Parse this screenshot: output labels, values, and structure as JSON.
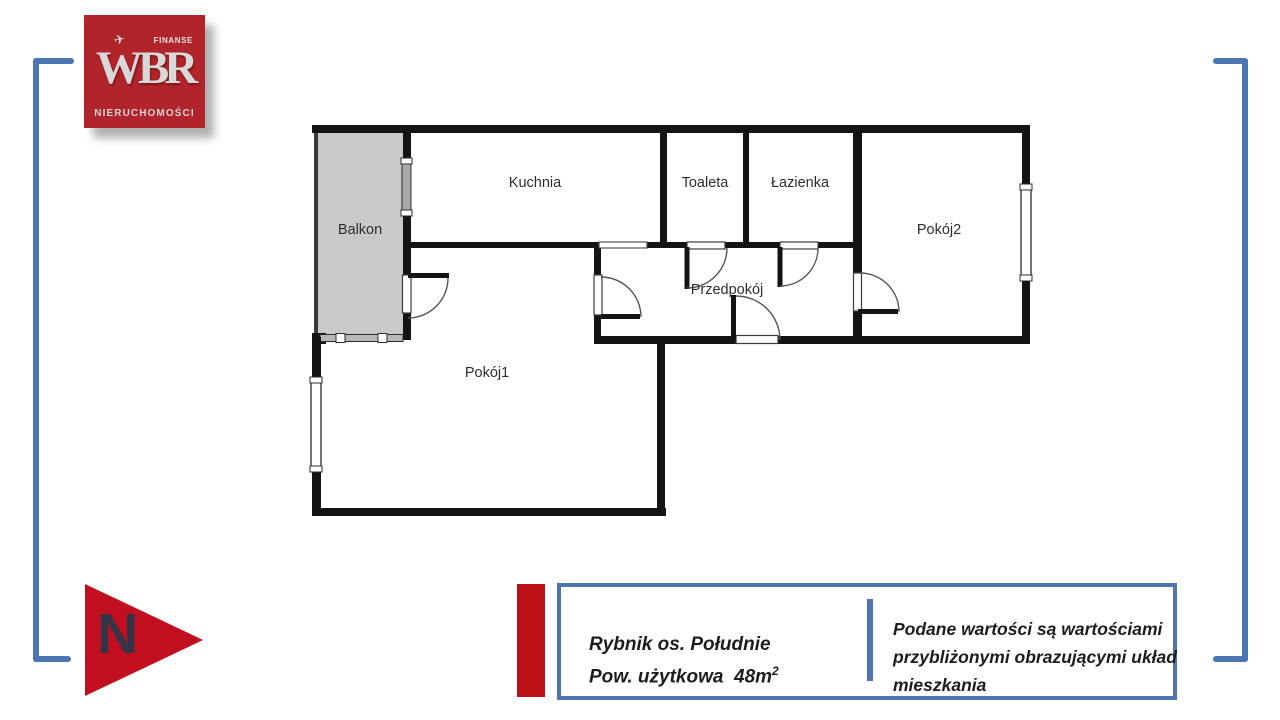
{
  "logo": {
    "finanse": "FINANSE",
    "wbr": "WBR",
    "nieruchomosci": "NIERUCHOMOŚCI",
    "plane_icon": "✈"
  },
  "plan": {
    "rooms": [
      {
        "id": "kuchnia",
        "label": "Kuchnia"
      },
      {
        "id": "toaleta",
        "label": "Toaleta"
      },
      {
        "id": "lazienka",
        "label": "Łazienka"
      },
      {
        "id": "pokoj2",
        "label": "Pokój2"
      },
      {
        "id": "przedpokoj",
        "label": "Przedpokój"
      },
      {
        "id": "pokoj1",
        "label": "Pokój1"
      },
      {
        "id": "balkon",
        "label": "Balkon"
      }
    ]
  },
  "north": {
    "label": "N"
  },
  "info": {
    "location": "Rybnik os. Południe",
    "area_label": "Pow. użytkowa",
    "area_value": "48m",
    "area_sup": "2",
    "disclaimer": "Podane wartości są wartościami przybliżonymi obrazującymi układ mieszkania"
  },
  "colors": {
    "brand_red": "#b2242b",
    "arrow_red": "#c10f1f",
    "accent_blue": "#4d75b3",
    "wall_black": "#141414",
    "balcony_gray": "#c9c9c9"
  }
}
